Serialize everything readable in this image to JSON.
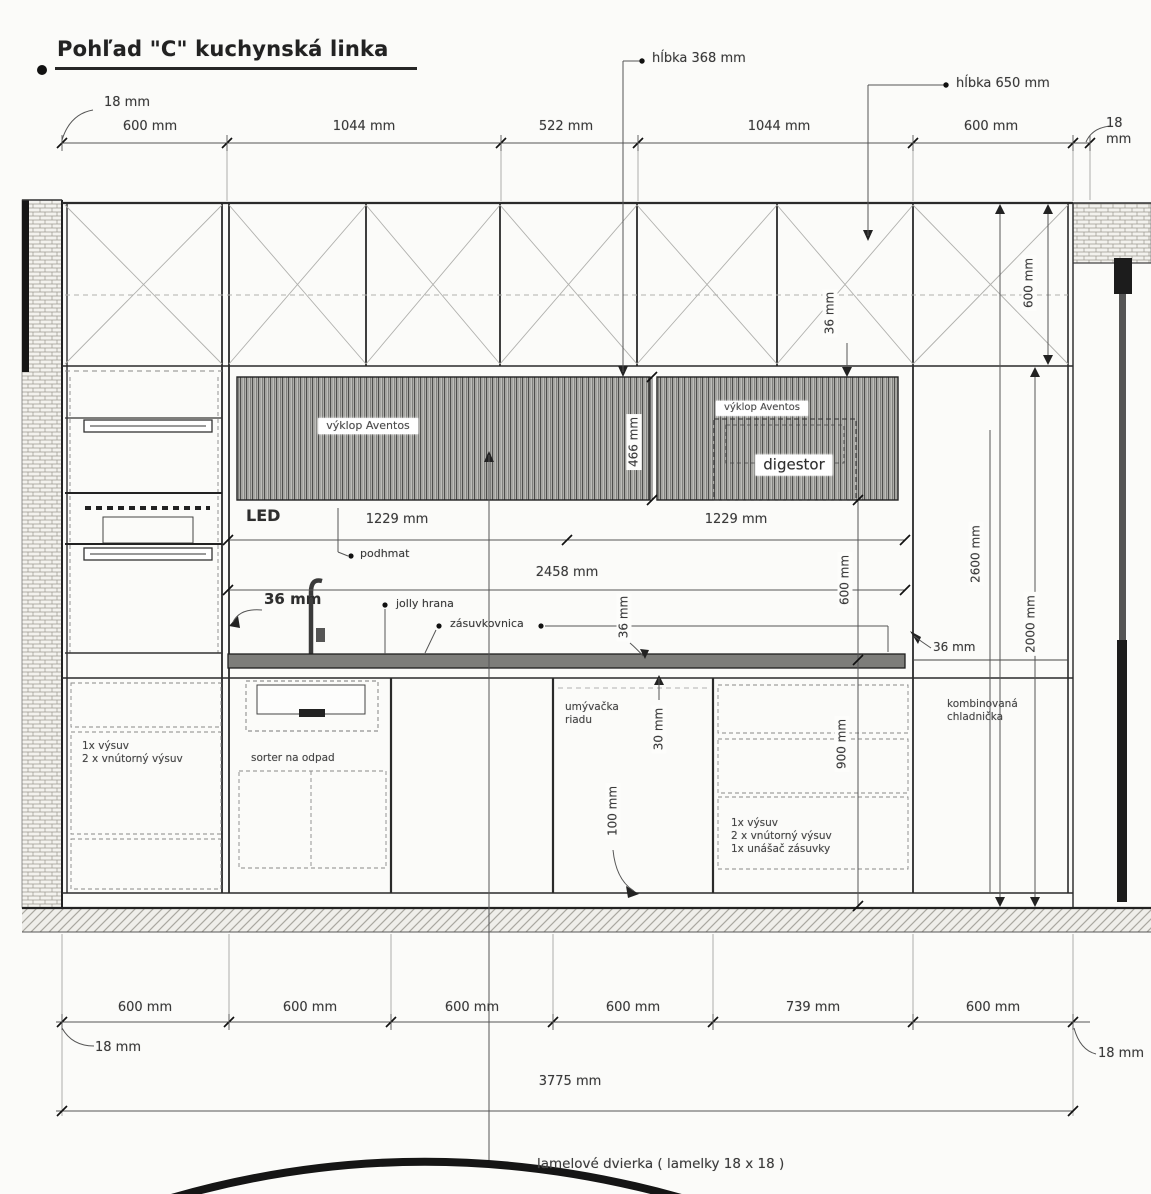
{
  "title": "Pohľad \"C\" kuchynská linka",
  "top_dims": {
    "panel_left": "18 mm",
    "segments": [
      "600 mm",
      "1044 mm",
      "522 mm",
      "1044 mm",
      "600 mm"
    ],
    "panel_right": "18 mm",
    "depth_upper": "hĺbka 368 mm",
    "depth_tall": "hĺbka 650 mm"
  },
  "upper": {
    "trim": "36 mm",
    "upper_height": "600 mm",
    "aventos_left": "výklop Aventos",
    "aventos_right": "výklop Aventos",
    "digestor": "digestor",
    "band_height": "466 mm",
    "led": "LED"
  },
  "counter": {
    "left_half": "1229 mm",
    "right_half": "1229 mm",
    "total": "2458 mm",
    "podhmat": "podhmat",
    "thickness": "36 mm",
    "jolly": "jolly hrana",
    "zasuvkovnica": "zásuvkovnica",
    "mid_gap": "36 mm",
    "backsplash": "600 mm",
    "fridge_gap": "36 mm",
    "overhang": "30 mm",
    "height": "900 mm",
    "plinth": "100 mm"
  },
  "heights": {
    "total": "2600 mm",
    "fridge_niche": "2000 mm"
  },
  "cabinets": {
    "tall_drawers": "1x výsuv\n2 x vnútorný výsuv",
    "sorter": "sorter na odpad",
    "dishwasher": "umývačka\nriadu",
    "drawers": "1x výsuv\n2 x vnútorný výsuv\n1x unášač zásuvky",
    "fridge": "kombinovaná\nchladnička"
  },
  "bottom_dims": {
    "panel_left": "18 mm",
    "segments": [
      "600 mm",
      "600 mm",
      "600 mm",
      "600 mm",
      "739 mm",
      "600 mm"
    ],
    "panel_right": "18 mm",
    "total": "3775 mm",
    "note": "lamelové dvierka ( lamelky 18 x 18 )"
  }
}
